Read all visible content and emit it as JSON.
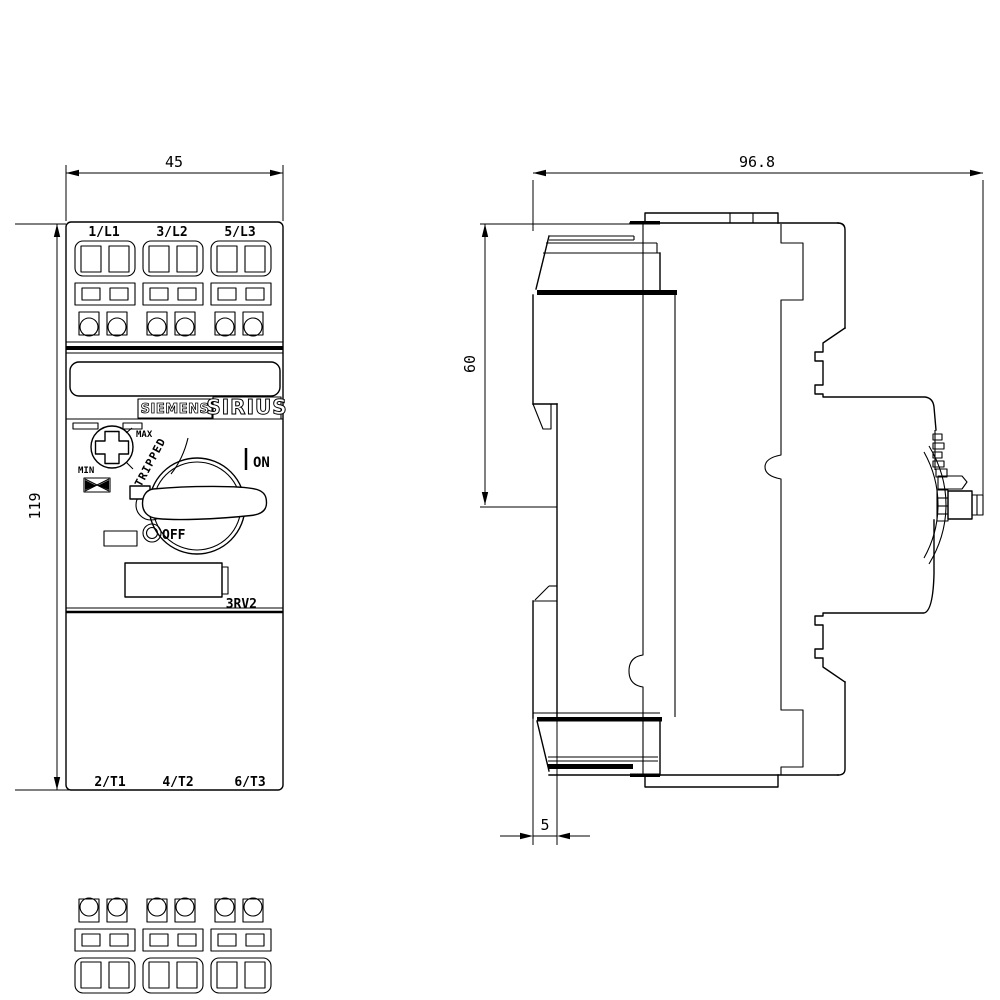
{
  "page": {
    "background": "#ffffff",
    "line_color": "#000000"
  },
  "front_view": {
    "terminals_top": [
      "1/L1",
      "3/L2",
      "5/L3"
    ],
    "terminals_bottom": [
      "2/T1",
      "4/T2",
      "6/T3"
    ],
    "brand_siemens": "SIEMENS",
    "brand_sirius": "SIRIUS",
    "model": "3RV2",
    "dial_max": "MAX",
    "dial_min": "MIN",
    "tripped_label": "TRIPPED",
    "on_label": "ON",
    "off_label": "OFF",
    "dim_width_mm": "45",
    "dim_height_mm": "119"
  },
  "side_view": {
    "dim_depth_mm": "96.8",
    "dim_rail_mm": "60",
    "dim_offset_mm": "5"
  }
}
